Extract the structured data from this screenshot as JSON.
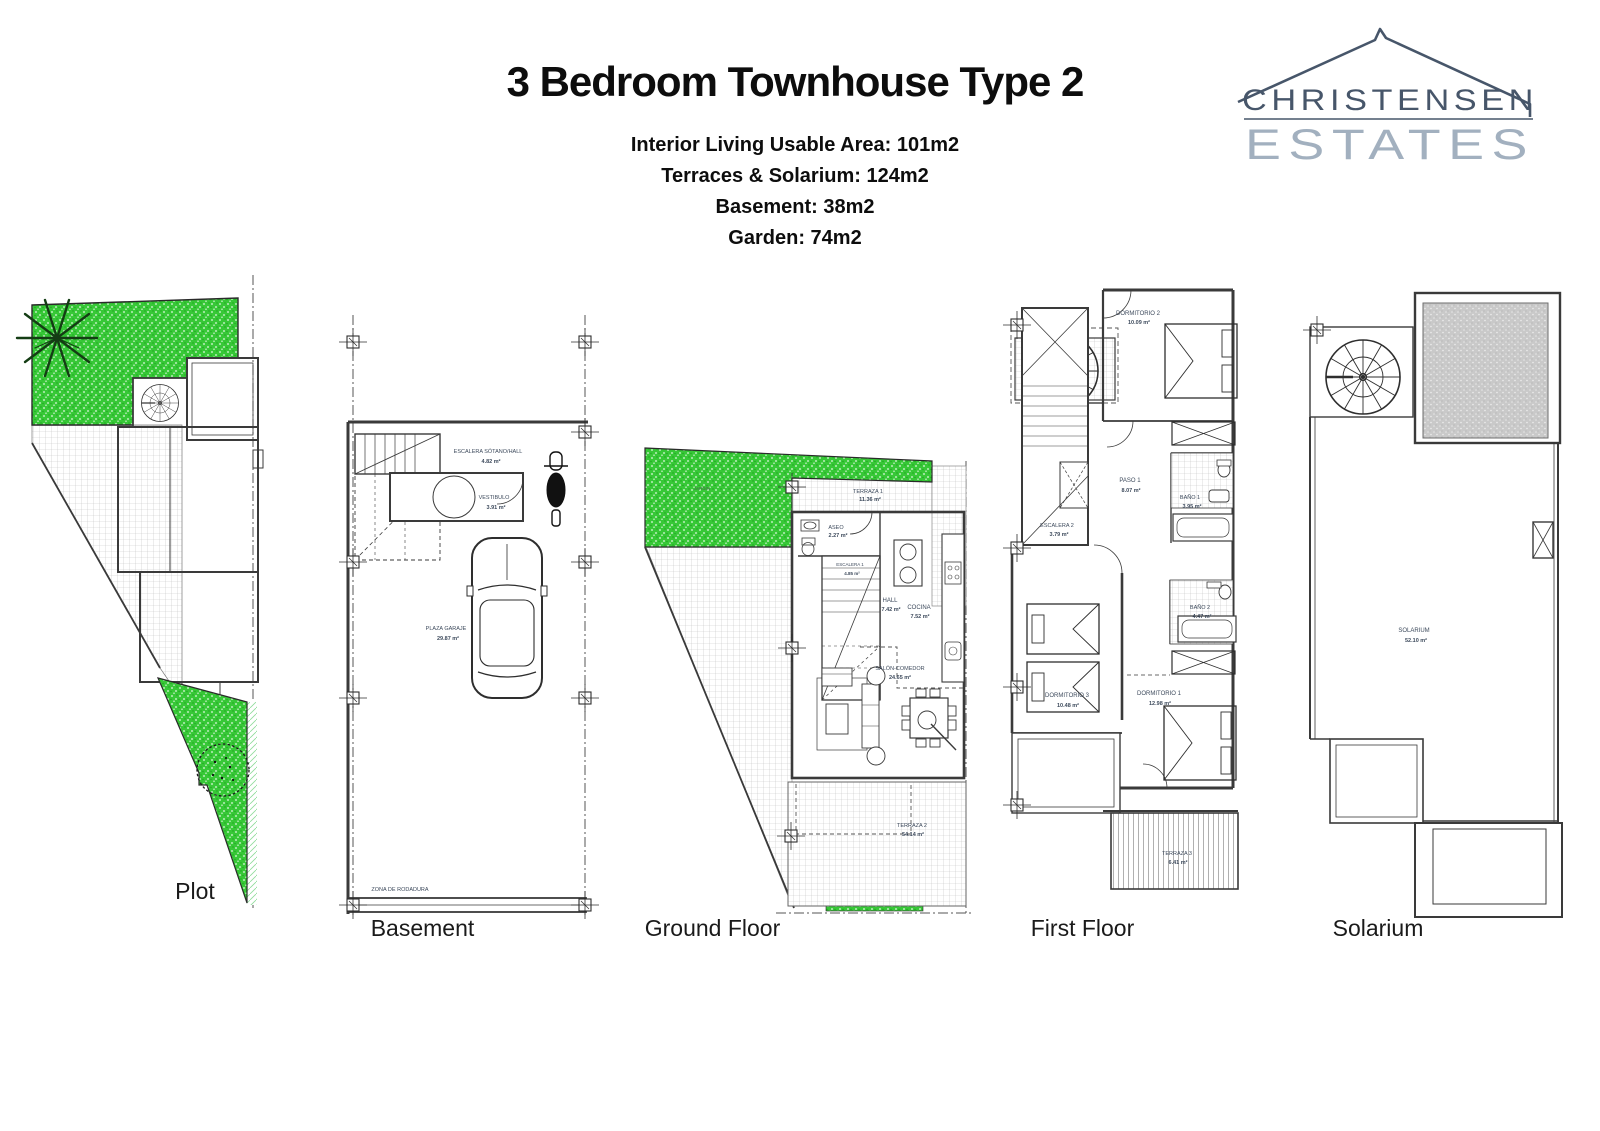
{
  "header": {
    "title": "3 Bedroom Townhouse Type 2",
    "stats": [
      "Interior Living Usable Area: 101m2",
      "Terraces & Solarium: 124m2",
      "Basement: 38m2",
      "Garden: 74m2"
    ]
  },
  "logo": {
    "line1": "CHRISTENSEN",
    "line2": "ESTATES"
  },
  "colors": {
    "garden_green": "#37c837",
    "pergola_gray": "#c8c8c8",
    "logo_dark": "#47566a",
    "logo_light": "#a2b0bf"
  },
  "plans": {
    "plot": {
      "caption": "Plot"
    },
    "basement": {
      "caption": "Basement",
      "rooms": {
        "stairs": {
          "name": "ESCALERA SÓTANO/HALL",
          "area": "4.82 m²"
        },
        "vestibulo": {
          "name": "VESTIBULO",
          "area": "3.91 m²"
        },
        "garaje": {
          "name": "PLAZA GARAJE",
          "area": "29.87 m²"
        },
        "rodadura": {
          "name": "ZONA DE RODADURA",
          "area": ""
        }
      }
    },
    "ground": {
      "caption": "Ground Floor",
      "rooms": {
        "terraza1": {
          "name": "TERRAZA 1",
          "area": "11.36 m²"
        },
        "jardin": {
          "name": "JARDÍN",
          "area": ""
        },
        "aseo": {
          "name": "ASEO",
          "area": "2.27 m²"
        },
        "escalera": {
          "name": "ESCALERA 1",
          "area": "4.85 m²"
        },
        "hall": {
          "name": "HALL",
          "area": "7.42 m²"
        },
        "cocina": {
          "name": "COCINA",
          "area": "7.52 m²"
        },
        "salon": {
          "name": "SALÓN-COMEDOR",
          "area": "24.65 m²"
        },
        "terraza2": {
          "name": "TERRAZA 2",
          "area": "54.14 m²"
        }
      }
    },
    "first": {
      "caption": "First Floor",
      "rooms": {
        "dorm2": {
          "name": "DORMITORIO 2",
          "area": "10.09 m²"
        },
        "paso": {
          "name": "PASO 1",
          "area": "8.07 m²"
        },
        "bano1": {
          "name": "BAÑO 1",
          "area": "3.95 m²"
        },
        "escalera2": {
          "name": "ESCALERA 2",
          "area": "3.79 m²"
        },
        "bano2": {
          "name": "BAÑO 2",
          "area": "4.47 m²"
        },
        "dorm3": {
          "name": "DORMITORIO 3",
          "area": "10.48 m²"
        },
        "dorm1": {
          "name": "DORMITORIO 1",
          "area": "12.98 m²"
        },
        "terraza3": {
          "name": "TERRAZA 3",
          "area": "6.41 m²"
        }
      }
    },
    "solarium": {
      "caption": "Solarium",
      "rooms": {
        "solarium": {
          "name": "SOLARIUM",
          "area": "52.10 m²"
        }
      }
    }
  }
}
